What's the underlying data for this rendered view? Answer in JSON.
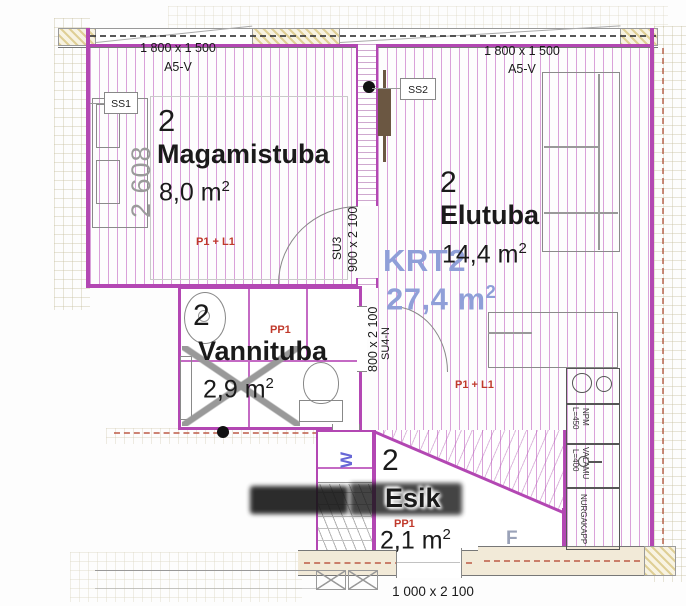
{
  "drawing": {
    "apartment": {
      "code": "KRT2",
      "area_value": "27,4",
      "area_unit": "m",
      "area_exp": "2"
    },
    "rooms": {
      "bedroom": {
        "number": "2",
        "name": "Magamistuba",
        "area_value": "8,0",
        "area_unit": "m",
        "area_exp": "2",
        "floor_code": "P1 + L1"
      },
      "livingroom": {
        "number": "2",
        "name": "Elutuba",
        "area_value": "14,4",
        "area_unit": "m",
        "area_exp": "2",
        "floor_code": "P1 + L1"
      },
      "bathroom": {
        "number": "2",
        "name": "Vannituba",
        "area_value": "2,9",
        "area_unit": "m",
        "area_exp": "2",
        "floor_code": "PP1"
      },
      "hallway": {
        "number": "2",
        "name": "Esik",
        "area_value": "2,1",
        "area_unit": "m",
        "area_exp": "2",
        "floor_code": "PP1"
      }
    },
    "windows": {
      "left": {
        "size": "1 800 x 1 500",
        "type": "A5-V"
      },
      "right": {
        "size": "1 800 x 1 500",
        "type": "A5-V"
      }
    },
    "doors": {
      "su3": {
        "code": "SU3",
        "size": "900 x 2 100"
      },
      "su4": {
        "code": "SU4-N",
        "size": "800 x 2 100"
      },
      "entrance": {
        "size": "1 000 x 2 100"
      }
    },
    "switches": {
      "ss1": "SS1",
      "ss2": "SS2"
    },
    "dimensions": {
      "bed_width": "2 608"
    },
    "kitchen": {
      "npm_label": "NPM",
      "npm_length": "L=450",
      "sink_label": "VALAMU",
      "sink_length": "L=400",
      "corner_cabinet": "NURGAKAPP",
      "fridge_label": "F"
    },
    "laundry": {
      "washer_label": "W"
    },
    "colors": {
      "wall_magenta": "#b347b3",
      "hatch_stripe": "#bb55bb",
      "apartment_code_blue": "#8f9fd8",
      "floor_code_red": "#c0392b",
      "furniture_gray": "#8a8a8a",
      "door_panel_brown": "#6b5742"
    }
  }
}
